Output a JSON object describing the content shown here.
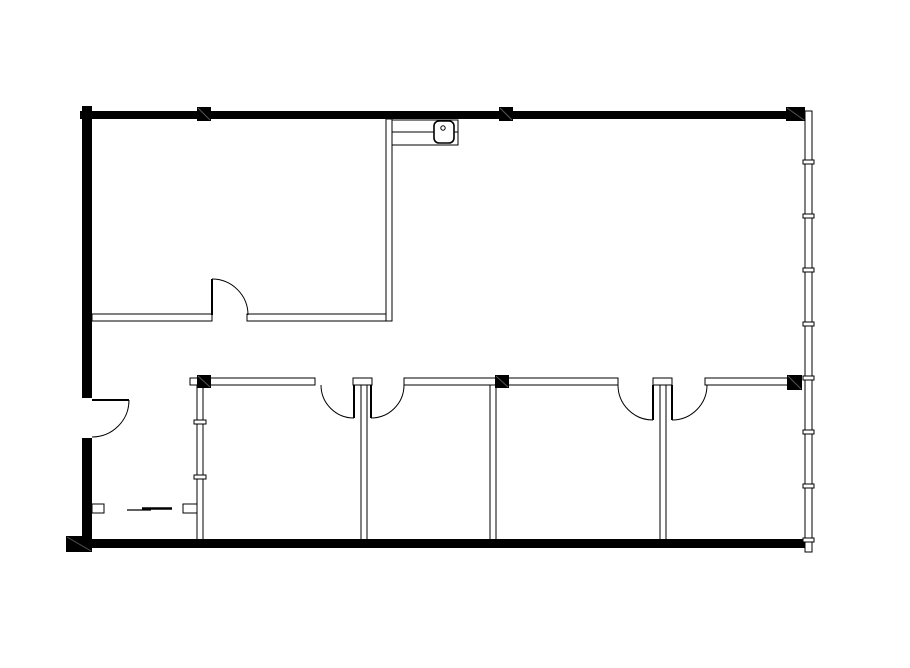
{
  "canvas": {
    "width": 910,
    "height": 668,
    "background": "#ffffff",
    "ink": "#000000"
  },
  "floor_plan": {
    "exterior_walls": [
      {
        "name": "top-exterior-wall",
        "x": 80,
        "y": 111,
        "w": 708,
        "h": 8
      },
      {
        "name": "left-exterior-wall-upper",
        "x": 82,
        "y": 106,
        "w": 10,
        "h": 292
      },
      {
        "name": "left-exterior-wall-lower",
        "x": 82,
        "y": 438,
        "w": 10,
        "h": 110
      },
      {
        "name": "bottom-exterior-wall",
        "x": 80,
        "y": 539,
        "w": 725,
        "h": 9
      }
    ],
    "columns": [
      {
        "name": "column-top-left",
        "x": 197,
        "y": 107,
        "w": 14,
        "h": 14
      },
      {
        "name": "column-top-center",
        "x": 499,
        "y": 107,
        "w": 14,
        "h": 14
      },
      {
        "name": "column-top-right",
        "x": 786,
        "y": 107,
        "w": 19,
        "h": 14
      },
      {
        "name": "column-mid-left",
        "x": 197,
        "y": 375,
        "w": 14,
        "h": 13
      },
      {
        "name": "column-mid-center",
        "x": 495,
        "y": 375,
        "w": 14,
        "h": 13
      },
      {
        "name": "column-mid-right",
        "x": 787,
        "y": 375,
        "w": 15,
        "h": 15
      },
      {
        "name": "column-bottom-left-corner",
        "x": 66,
        "y": 536,
        "w": 26,
        "h": 16
      }
    ],
    "window_wall": {
      "name": "right-window-wall",
      "x": 805,
      "y": 111,
      "w": 7,
      "h": 441,
      "mullions_y": [
        162,
        216,
        270,
        324,
        378,
        432,
        486,
        540
      ],
      "mullion_w": 11,
      "mullion_h": 4
    },
    "interior_walls": [
      {
        "name": "private-office-south-wall-left",
        "x": 92,
        "y": 314,
        "w": 120,
        "h": 7
      },
      {
        "name": "private-office-south-wall-right",
        "x": 247,
        "y": 314,
        "w": 143,
        "h": 7
      },
      {
        "name": "private-office-east-wall",
        "x": 386,
        "y": 119,
        "w": 6,
        "h": 202
      },
      {
        "name": "corridor-wall-segment-a",
        "x": 190,
        "y": 378,
        "w": 125,
        "h": 7
      },
      {
        "name": "corridor-wall-stub-1",
        "x": 353,
        "y": 378,
        "w": 19,
        "h": 7
      },
      {
        "name": "corridor-wall-segment-b",
        "x": 404,
        "y": 378,
        "w": 214,
        "h": 7
      },
      {
        "name": "corridor-wall-stub-2",
        "x": 653,
        "y": 378,
        "w": 19,
        "h": 7
      },
      {
        "name": "corridor-wall-segment-c",
        "x": 705,
        "y": 378,
        "w": 84,
        "h": 7
      },
      {
        "name": "office-partition-1",
        "x": 197,
        "y": 385,
        "w": 6,
        "h": 155
      },
      {
        "name": "office-partition-2",
        "x": 361,
        "y": 385,
        "w": 6,
        "h": 155
      },
      {
        "name": "office-partition-3",
        "x": 490,
        "y": 385,
        "w": 6,
        "h": 155
      },
      {
        "name": "office-partition-4",
        "x": 660,
        "y": 385,
        "w": 6,
        "h": 155
      },
      {
        "name": "closet-jamb-left",
        "x": 92,
        "y": 504,
        "w": 12,
        "h": 9
      },
      {
        "name": "closet-jamb-right",
        "x": 183,
        "y": 504,
        "w": 14,
        "h": 9
      }
    ],
    "partition_ticks": [
      {
        "name": "partition-1-joint-upper",
        "x": 194,
        "y": 420,
        "w": 12,
        "h": 4
      },
      {
        "name": "partition-1-joint-lower",
        "x": 194,
        "y": 475,
        "w": 12,
        "h": 4
      }
    ],
    "doors": [
      {
        "name": "entry-door",
        "leaf": {
          "x1": 92,
          "y1": 400,
          "x2": 129,
          "y2": 400
        },
        "arc": {
          "r": 37,
          "sweep": 1,
          "tip": [
            129,
            400
          ],
          "end": [
            92,
            437
          ]
        }
      },
      {
        "name": "private-office-door",
        "leaf": {
          "x1": 212,
          "y1": 315,
          "x2": 212,
          "y2": 279
        },
        "arc": {
          "r": 36,
          "sweep": 1,
          "tip": [
            212,
            279
          ],
          "end": [
            248,
            315
          ]
        }
      },
      {
        "name": "office-1-door",
        "leaf": {
          "x1": 354,
          "y1": 385,
          "x2": 354,
          "y2": 418
        },
        "arc": {
          "r": 33,
          "sweep": 1,
          "tip": [
            354,
            418
          ],
          "end": [
            321,
            385
          ]
        }
      },
      {
        "name": "office-2-door",
        "leaf": {
          "x1": 371,
          "y1": 385,
          "x2": 371,
          "y2": 418
        },
        "arc": {
          "r": 33,
          "sweep": 0,
          "tip": [
            371,
            418
          ],
          "end": [
            404,
            385
          ]
        }
      },
      {
        "name": "office-3-door",
        "leaf": {
          "x1": 653,
          "y1": 385,
          "x2": 653,
          "y2": 420
        },
        "arc": {
          "r": 35,
          "sweep": 1,
          "tip": [
            653,
            420
          ],
          "end": [
            618,
            385
          ]
        }
      },
      {
        "name": "office-4-door",
        "leaf": {
          "x1": 672,
          "y1": 385,
          "x2": 672,
          "y2": 420
        },
        "arc": {
          "r": 35,
          "sweep": 0,
          "tip": [
            672,
            420
          ],
          "end": [
            707,
            385
          ]
        }
      }
    ],
    "sliding_door": {
      "name": "closet-sliding-door",
      "lines": [
        {
          "x1": 127,
          "y1": 510,
          "x2": 151,
          "y2": 510,
          "w": 1.2
        },
        {
          "x1": 142,
          "y1": 508.5,
          "x2": 172,
          "y2": 508.5,
          "w": 2.6
        }
      ]
    },
    "fixtures": {
      "counter": {
        "name": "kitchenette-counter",
        "x": 392,
        "y": 120,
        "w": 66,
        "h": 25,
        "divider_y": 132
      },
      "sink": {
        "name": "sink",
        "x": 434,
        "y": 121,
        "w": 20,
        "h": 22,
        "rx": 5
      },
      "faucet": {
        "name": "sink-drain",
        "cx": 443,
        "cy": 128,
        "r": 2.2
      }
    }
  }
}
